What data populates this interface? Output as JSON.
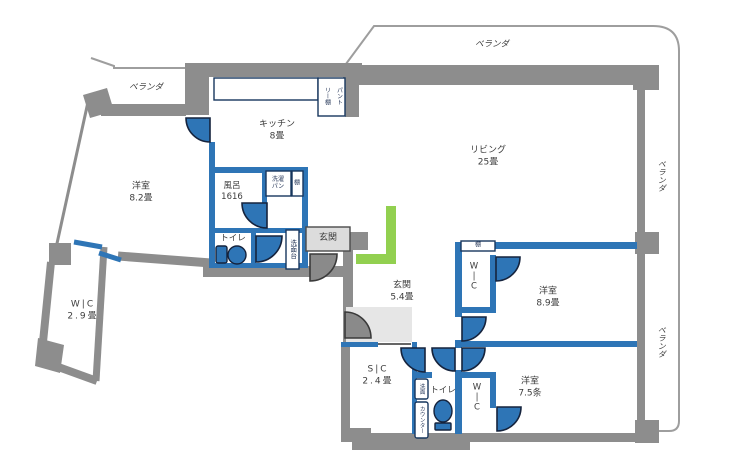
{
  "palette": {
    "wall_gray": "#8d8d8d",
    "balcony_outline_gray": "#9e9e9e",
    "partition_blue": "#2e75b6",
    "door_leaf_blue": "#2e75b6",
    "door_leaf_gray": "#8a8a8a",
    "fixture_border_navy": "#17365d",
    "accent_green": "#92d050",
    "entrance_floor_gray": "#e6e6e6",
    "entrance_box_gray": "#dcdcdc",
    "text_gray": "#3d3d3d"
  },
  "balconies": {
    "top_left": {
      "label": "ベランダ"
    },
    "top": {
      "label": "ベランダ"
    },
    "right_upper": {
      "label": "ベランダ"
    },
    "right_lower": {
      "label": "ベランダ"
    }
  },
  "rooms": {
    "living": {
      "name": "リビング",
      "size": "25畳"
    },
    "kitchen": {
      "name": "キッチン",
      "size": "8畳"
    },
    "bedroom_west": {
      "name": "洋室",
      "size": "8.2畳"
    },
    "wic_west": {
      "name": "W|C",
      "size": "2.9畳"
    },
    "bath": {
      "name": "風呂",
      "size": "1616"
    },
    "toilet": {
      "name": "トイレ"
    },
    "entrance_box": {
      "name": "玄関"
    },
    "entrance_hall": {
      "name": "玄関",
      "size": "5.4畳"
    },
    "sic": {
      "name": "S|C",
      "size": "2.4畳"
    },
    "toilet2": {
      "name": "トイレ"
    },
    "bedroom_ne": {
      "name": "洋室",
      "size": "8.9畳"
    },
    "bedroom_se": {
      "name": "洋室",
      "size": "7.5条"
    },
    "wic_ne": {
      "l1": "W",
      "l2": "|",
      "l3": "C"
    },
    "wic_se": {
      "l1": "W",
      "l2": "|",
      "l3": "C"
    }
  },
  "fixtures": {
    "pantry_col_right": "パント",
    "pantry_col_left": "リー棚",
    "laundry_l1": "洗濯",
    "laundry_l2": "パン",
    "shelf": "棚",
    "washstand": "洗面台",
    "wash_counter_l1": "洗面",
    "wash_counter_l2": "カウンター",
    "bedroom_shelf": "棚"
  }
}
